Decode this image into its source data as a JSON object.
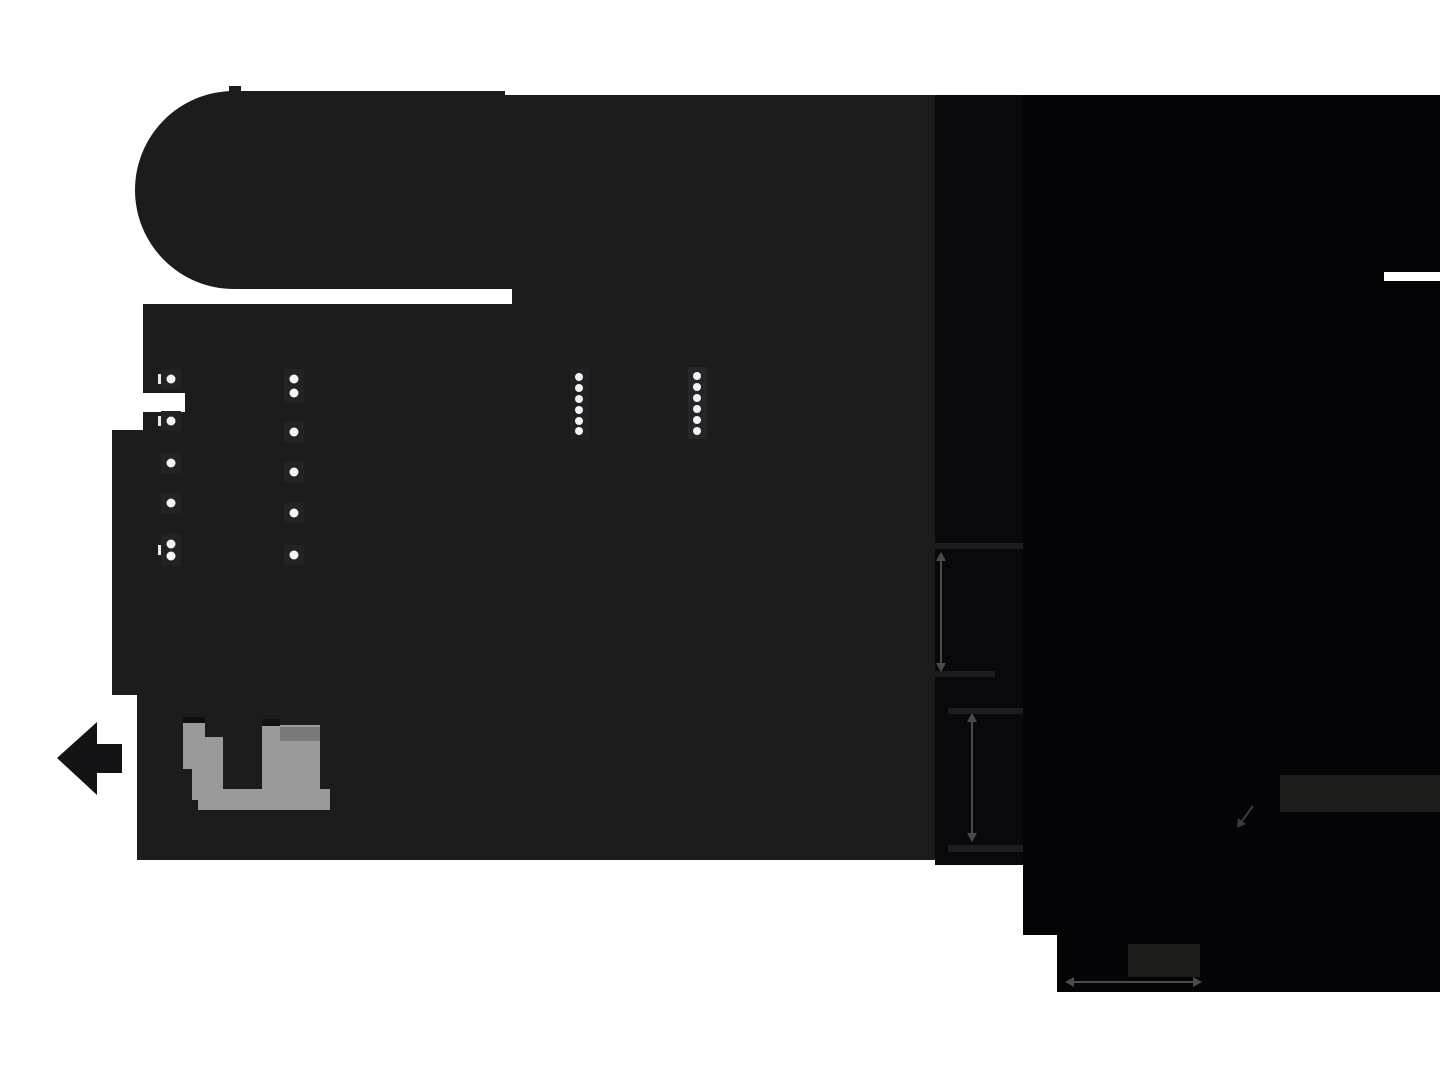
{
  "figure": {
    "kind": "product-dimension-diagram",
    "description": "Dark device silhouette viewed at an angle with faint dimension arrows, white indicator dots, LED meter dots and a gray connector shape on a white page background",
    "background": "#FFFFFF"
  },
  "palette": {
    "body": "#1C1C1C",
    "seam": "#09090B",
    "right_body": "#050507",
    "panel_light_a": "#1D1D1B",
    "panel_light_b": "#1C1C1A",
    "ext_band": "#1D1D1F",
    "dim_line": "#4B4B4E",
    "diag_arrow": "#3A3A3E",
    "connector_gray": "#9A9A9A",
    "connector_shade": "#787878",
    "connector_cap": "#101012",
    "pad": "#232326",
    "led_panel_a": "#212125",
    "led_panel_b": "#26262A",
    "dot_white": "#F3F3F3",
    "tick_white": "#E8E8E8",
    "arrow_black": "#141416",
    "white": "#FFFFFF"
  },
  "canvas": {
    "width": 1440,
    "height": 1080
  },
  "shapes": [
    {
      "name": "device-body-silhouette",
      "type": "path",
      "fill": "#1C1C1C",
      "d": "M 234 91 A 99 99 0 0 0 234 289 L 512 289 L 512 304 L 143 304 L 143 393 L 185 393 L 185 412 L 143 412 L 143 430 L 112 430 L 112 695 L 137 695 L 137 860 L 935 860 L 935 95 L 505 95 L 505 91 Z"
    },
    {
      "name": "device-top-nub",
      "type": "rect",
      "x": 229,
      "y": 86,
      "w": 12,
      "h": 6,
      "fill": "#1C1C1C"
    },
    {
      "name": "device-seam-strip",
      "type": "rect",
      "x": 935,
      "y": 95,
      "w": 88,
      "h": 770,
      "fill": "#09090B"
    },
    {
      "name": "device-rear-block",
      "type": "path",
      "fill": "#050507",
      "d": "M 1023 95 L 1440 95 L 1440 992 L 1057 992 L 1057 935 L 1023 935 Z"
    },
    {
      "name": "rear-edge-highlight",
      "type": "rect",
      "x": 1384,
      "y": 272,
      "w": 56,
      "h": 9,
      "fill": "#FFFFFF"
    },
    {
      "name": "rear-panel-facet",
      "type": "rect",
      "x": 1280,
      "y": 775,
      "w": 160,
      "h": 37,
      "fill": "#1D1D1B"
    },
    {
      "name": "base-facet",
      "type": "rect",
      "x": 1128,
      "y": 944,
      "w": 72,
      "h": 33,
      "fill": "#1C1C1A"
    },
    {
      "name": "extension-line-top",
      "type": "rect",
      "x": 935,
      "y": 543,
      "w": 88,
      "h": 6,
      "fill": "#1D1D1F"
    },
    {
      "name": "extension-line-mid-upper",
      "type": "rect",
      "x": 935,
      "y": 671,
      "w": 60,
      "h": 6,
      "fill": "#1D1D1F"
    },
    {
      "name": "extension-line-mid-lower",
      "type": "rect",
      "x": 948,
      "y": 708,
      "w": 75,
      "h": 6,
      "fill": "#1D1D1F"
    },
    {
      "name": "extension-line-bottom",
      "type": "rect",
      "x": 948,
      "y": 845,
      "w": 75,
      "h": 7,
      "fill": "#1D1D1F"
    },
    {
      "name": "height-dimension-line",
      "type": "line",
      "x1": 941,
      "y1": 560,
      "x2": 941,
      "y2": 665,
      "stroke": "#4B4B4E",
      "width": 2
    },
    {
      "name": "height-dimension-arrow-up",
      "type": "polygon",
      "points": "941,552 946,561 936,561",
      "fill": "#4B4B4E"
    },
    {
      "name": "height-dimension-arrow-down",
      "type": "polygon",
      "points": "941,672 946,663 936,663",
      "fill": "#4B4B4E"
    },
    {
      "name": "depth-dimension-line",
      "type": "line",
      "x1": 972,
      "y1": 721,
      "x2": 972,
      "y2": 834,
      "stroke": "#4B4B4E",
      "width": 2
    },
    {
      "name": "depth-dimension-arrow-up",
      "type": "polygon",
      "points": "972,713 977,722 967,722",
      "fill": "#4B4B4E"
    },
    {
      "name": "depth-dimension-arrow-down",
      "type": "polygon",
      "points": "972,842 977,833 967,833",
      "fill": "#4B4B4E"
    },
    {
      "name": "width-dimension-line",
      "type": "line",
      "x1": 1073,
      "y1": 982,
      "x2": 1194,
      "y2": 982,
      "stroke": "#4B4B4E",
      "width": 2
    },
    {
      "name": "width-dimension-arrow-left",
      "type": "polygon",
      "points": "1065,982 1074,977 1074,987",
      "fill": "#4B4B4E"
    },
    {
      "name": "width-dimension-arrow-right",
      "type": "polygon",
      "points": "1202,982 1193,977 1193,987",
      "fill": "#4B4B4E"
    },
    {
      "name": "corner-pointer-line",
      "type": "line",
      "x1": 1253,
      "y1": 806,
      "x2": 1242,
      "y2": 821,
      "stroke": "#3A3A3E",
      "width": 2
    },
    {
      "name": "corner-pointer-arrowhead",
      "type": "polygon",
      "points": "1237,828 1238,818 1246,824",
      "fill": "#3A3A3E"
    },
    {
      "name": "left-pointer-arrow",
      "type": "path",
      "fill": "#141416",
      "d": "M 57 758 L 97 722 L 97 744 L 122 744 L 122 773 L 97 773 L 97 795 Z"
    },
    {
      "name": "usb-connector-left-leg",
      "type": "path",
      "fill": "#9A9A9A",
      "d": "M 183 722 L 205 722 L 205 737 L 223 737 L 223 800 L 192 800 L 192 769 L 183 769 Z"
    },
    {
      "name": "usb-connector-right-leg",
      "type": "rect",
      "x": 262,
      "y": 725,
      "w": 58,
      "h": 85,
      "fill": "#9A9A9A"
    },
    {
      "name": "usb-connector-bottom-bar",
      "type": "rect",
      "x": 198,
      "y": 789,
      "w": 132,
      "h": 21,
      "fill": "#9A9A9A"
    },
    {
      "name": "usb-connector-cap-left",
      "type": "rect",
      "x": 183,
      "y": 717,
      "w": 22,
      "h": 6,
      "fill": "#101012"
    },
    {
      "name": "usb-connector-cap-right",
      "type": "rect",
      "x": 262,
      "y": 719,
      "w": 18,
      "h": 7,
      "fill": "#101012"
    },
    {
      "name": "usb-connector-shade",
      "type": "rect",
      "x": 280,
      "y": 727,
      "w": 40,
      "h": 14,
      "fill": "#787878"
    },
    {
      "name": "button-pad",
      "type": "rect",
      "x": 161,
      "y": 369,
      "w": 20,
      "h": 20,
      "fill": "#232326"
    },
    {
      "name": "button-pad",
      "type": "rect",
      "x": 161,
      "y": 411,
      "w": 20,
      "h": 20,
      "fill": "#232326"
    },
    {
      "name": "button-pad",
      "type": "rect",
      "x": 161,
      "y": 453,
      "w": 20,
      "h": 20,
      "fill": "#232326"
    },
    {
      "name": "button-pad",
      "type": "rect",
      "x": 161,
      "y": 493,
      "w": 20,
      "h": 20,
      "fill": "#232326"
    },
    {
      "name": "button-pad",
      "type": "rect",
      "x": 161,
      "y": 534,
      "w": 20,
      "h": 32,
      "fill": "#232326"
    },
    {
      "name": "button-pad",
      "type": "rect",
      "x": 284,
      "y": 369,
      "w": 20,
      "h": 34,
      "fill": "#232326"
    },
    {
      "name": "button-pad",
      "type": "rect",
      "x": 284,
      "y": 422,
      "w": 20,
      "h": 20,
      "fill": "#232326"
    },
    {
      "name": "button-pad",
      "type": "rect",
      "x": 284,
      "y": 462,
      "w": 20,
      "h": 20,
      "fill": "#232326"
    },
    {
      "name": "button-pad",
      "type": "rect",
      "x": 284,
      "y": 503,
      "w": 20,
      "h": 20,
      "fill": "#232326"
    },
    {
      "name": "button-pad",
      "type": "rect",
      "x": 284,
      "y": 545,
      "w": 20,
      "h": 20,
      "fill": "#232326"
    },
    {
      "name": "led-meter-panel-left",
      "type": "rect",
      "x": 570,
      "y": 369,
      "w": 19,
      "h": 70,
      "fill": "#212125"
    },
    {
      "name": "led-meter-panel-right",
      "type": "rect",
      "x": 688,
      "y": 367,
      "w": 19,
      "h": 72,
      "fill": "#26262A"
    },
    {
      "name": "edge-tick",
      "type": "rect",
      "x": 158,
      "y": 374,
      "w": 3,
      "h": 10,
      "fill": "#E8E8E8"
    },
    {
      "name": "edge-tick",
      "type": "rect",
      "x": 158,
      "y": 416,
      "w": 3,
      "h": 10,
      "fill": "#E8E8E8"
    },
    {
      "name": "edge-tick",
      "type": "rect",
      "x": 158,
      "y": 545,
      "w": 3,
      "h": 10,
      "fill": "#E8E8E8"
    },
    {
      "name": "knob-indicator-dots-column-1",
      "type": "dots",
      "cx": 171,
      "r": 4.5,
      "fill": "#F3F3F3",
      "ys": [
        379,
        421,
        463,
        503,
        544,
        556
      ]
    },
    {
      "name": "knob-indicator-dots-column-2",
      "type": "dots",
      "cx": 294,
      "r": 4.5,
      "fill": "#F3F3F3",
      "ys": [
        379,
        393,
        432,
        472,
        513,
        555
      ]
    },
    {
      "name": "led-meter-dots-left",
      "type": "dots",
      "cx": 579,
      "r": 4,
      "fill": "#F3F3F3",
      "ys": [
        377,
        388,
        399,
        410,
        421,
        431
      ]
    },
    {
      "name": "led-meter-dots-right",
      "type": "dots",
      "cx": 697,
      "r": 4,
      "fill": "#F3F3F3",
      "ys": [
        376,
        387,
        398,
        409,
        420,
        431
      ]
    }
  ]
}
